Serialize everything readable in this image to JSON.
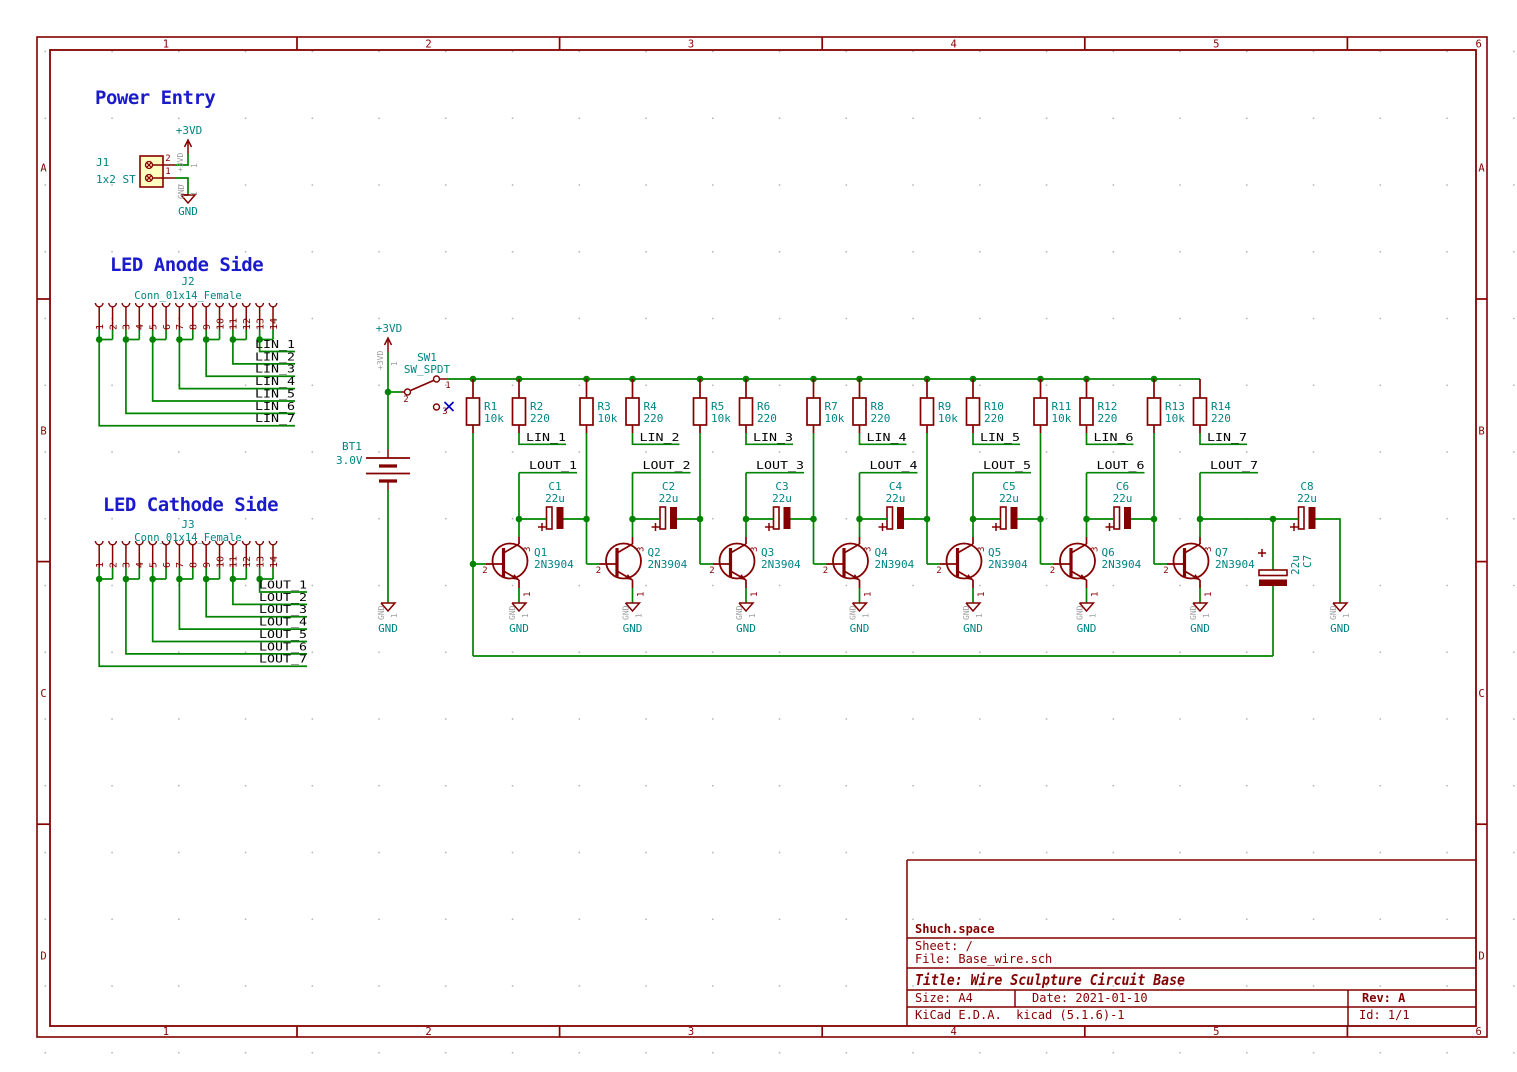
{
  "colors": {
    "wire": "#008400",
    "component": "#840000",
    "field": "#008484",
    "label": "#000000",
    "heading": "#1B1BCB",
    "gray": "#9E9E9E",
    "no_connect": "#0000C8",
    "frame": "#840000",
    "paper": "#FFFFFF",
    "connector_fill": "#FFFFC2",
    "grid_dot": "#B4B4B4"
  },
  "frame": {
    "columns": [
      "1",
      "2",
      "3",
      "4",
      "5",
      "6"
    ],
    "rows": [
      "A",
      "B",
      "C",
      "D"
    ]
  },
  "headings": {
    "power": "Power Entry",
    "anode": "LED Anode Side",
    "cathode": "LED Cathode Side"
  },
  "power_entry": {
    "ref": "J1",
    "value": "1x2 ST",
    "pin_top": "2",
    "pin_bottom": "1"
  },
  "anode": {
    "ref": "J2",
    "value": "Conn_01x14_Female",
    "pin_numbers": [
      "1",
      "2",
      "3",
      "4",
      "5",
      "6",
      "7",
      "8",
      "9",
      "10",
      "11",
      "12",
      "13",
      "14"
    ],
    "nets": [
      "LIN_1",
      "LIN_2",
      "LIN_3",
      "LIN_4",
      "LIN_5",
      "LIN_6",
      "LIN_7"
    ]
  },
  "cathode": {
    "ref": "J3",
    "value": "Conn_01x14_Female",
    "pin_numbers": [
      "1",
      "2",
      "3",
      "4",
      "5",
      "6",
      "7",
      "8",
      "9",
      "10",
      "11",
      "12",
      "13",
      "14"
    ],
    "nets": [
      "LOUT_1",
      "LOUT_2",
      "LOUT_3",
      "LOUT_4",
      "LOUT_5",
      "LOUT_6",
      "LOUT_7"
    ]
  },
  "supply": {
    "vcc": "+3VD",
    "gnd": "GND",
    "battery_ref": "BT1",
    "battery_value": "3.0V",
    "switch_ref": "SW1",
    "switch_value": "SW_SPDT",
    "switch_pin_1": "1",
    "switch_pin_2": "2",
    "switch_pin_3": "3"
  },
  "hidden_pins": {
    "gnd": "GND",
    "vcc": "+3VD",
    "number": "1"
  },
  "transistor_pins": {
    "emitter": "1",
    "base": "2",
    "collector": "3"
  },
  "stages": [
    {
      "r_base_ref": "R1",
      "r_base_value": "10k",
      "r_load_ref": "R2",
      "r_load_value": "220",
      "cap_ref": "C1",
      "cap_value": "22u",
      "q_ref": "Q1",
      "q_value": "2N3904"
    },
    {
      "r_base_ref": "R3",
      "r_base_value": "10k",
      "r_load_ref": "R4",
      "r_load_value": "220",
      "cap_ref": "C2",
      "cap_value": "22u",
      "q_ref": "Q2",
      "q_value": "2N3904"
    },
    {
      "r_base_ref": "R5",
      "r_base_value": "10k",
      "r_load_ref": "R6",
      "r_load_value": "220",
      "cap_ref": "C3",
      "cap_value": "22u",
      "q_ref": "Q3",
      "q_value": "2N3904"
    },
    {
      "r_base_ref": "R7",
      "r_base_value": "10k",
      "r_load_ref": "R8",
      "r_load_value": "220",
      "cap_ref": "C4",
      "cap_value": "22u",
      "q_ref": "Q4",
      "q_value": "2N3904"
    },
    {
      "r_base_ref": "R9",
      "r_base_value": "10k",
      "r_load_ref": "R10",
      "r_load_value": "220",
      "cap_ref": "C5",
      "cap_value": "22u",
      "q_ref": "Q5",
      "q_value": "2N3904"
    },
    {
      "r_base_ref": "R11",
      "r_base_value": "10k",
      "r_load_ref": "R12",
      "r_load_value": "220",
      "cap_ref": "C6",
      "cap_value": "22u",
      "q_ref": "Q6",
      "q_value": "2N3904"
    },
    {
      "r_base_ref": "R13",
      "r_base_value": "10k",
      "r_load_ref": "R14",
      "r_load_value": "220",
      "q_ref": "Q7",
      "q_value": "2N3904"
    }
  ],
  "output_caps": {
    "feedback_ref": "C7",
    "feedback_value": "22u",
    "output_ref": "C8",
    "output_value": "22u"
  },
  "title_block": {
    "company": "Shuch.space",
    "sheet": "Sheet: /",
    "file": "File: Base_wire.sch",
    "title": "Title: Wire Sculpture Circuit Base",
    "size": "Size: A4",
    "date": "Date: 2021-01-10",
    "rev": "Rev: A",
    "tool": "KiCad E.D.A.  kicad (5.1.6)-1",
    "id": "Id: 1/1"
  }
}
